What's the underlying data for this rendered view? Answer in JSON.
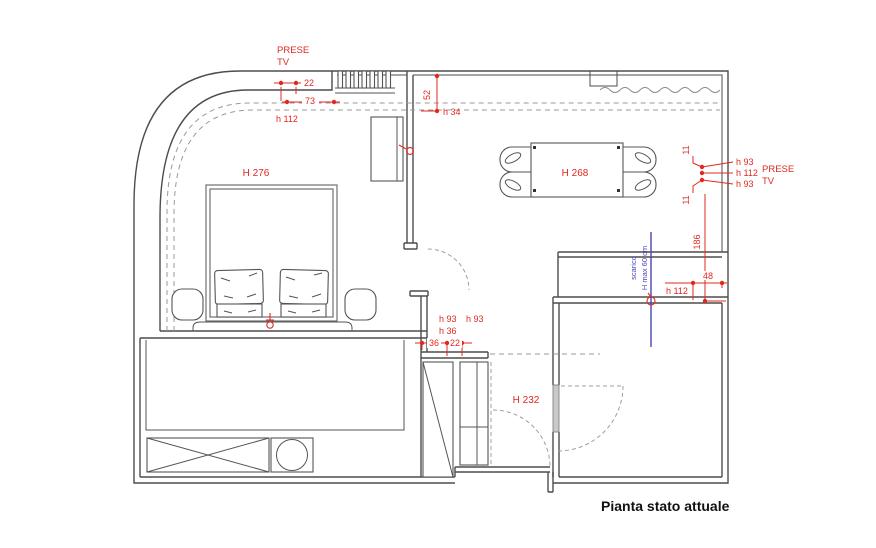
{
  "plan": {
    "title": "Pianta stato attuale",
    "room_labels": {
      "bedroom": "H 276",
      "dining": "H 268",
      "corridor": "H 232"
    },
    "outlets_left": {
      "l1": "PRESE",
      "l2": "TV"
    },
    "outlets_right": {
      "l1": "PRESE",
      "l2": "TV"
    },
    "dims": {
      "w22": "22",
      "w73": "73",
      "h112_tl": "h 112",
      "v52": "52",
      "h34": "h 34",
      "h93_r1": "h 93",
      "h112_r": "h 112",
      "h93_r2": "h 93",
      "g11_a": "11",
      "g11_b": "11",
      "v186": "186",
      "w48": "48",
      "h112_br": "h 112",
      "h93_m1": "h 93",
      "h93_m2": "h 93",
      "h36": "h 36",
      "w36": "36",
      "w22_b": "22"
    },
    "plumbing": {
      "l1": "scarico",
      "l2": "H max 60 cm"
    }
  },
  "colors": {
    "dim": "#e02820",
    "plumbing": "#4747b2",
    "wall": "#4d4d4d",
    "title": "#111111"
  }
}
